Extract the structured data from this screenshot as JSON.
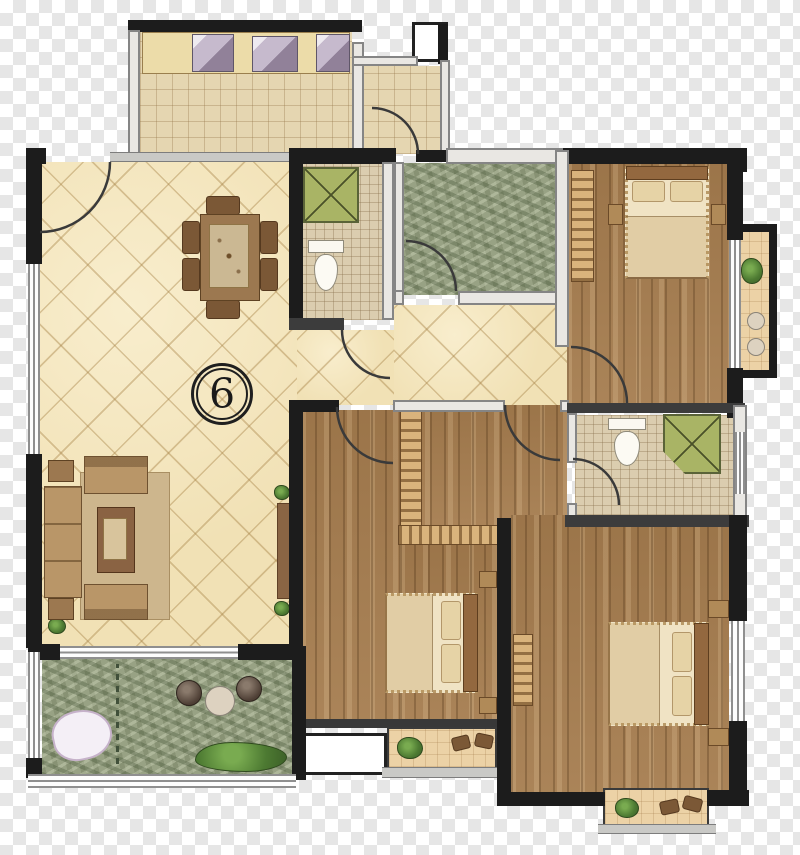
{
  "unit_label": "6",
  "plan": {
    "type": "apartment-floor-plan",
    "rooms": [
      {
        "name": "kitchen",
        "floor": "beige-grid-tile",
        "features": [
          "counter",
          "sink",
          "stove",
          "appliance"
        ]
      },
      {
        "name": "entry-porch",
        "floor": "beige-grid-tile",
        "features": [
          "duct-box",
          "door-swing"
        ]
      },
      {
        "name": "living-dining-room",
        "floor": "beige-diagonal-tile",
        "features": [
          "dining-table-with-six-chairs",
          "sofa-set",
          "coffee-table",
          "rug",
          "tv-cabinet",
          "unit-number-badge"
        ]
      },
      {
        "name": "shared-bathroom",
        "floor": "fine-mosaic-tile",
        "fixtures": [
          "shower",
          "toilet"
        ]
      },
      {
        "name": "multipurpose-room",
        "floor": "green-textured"
      },
      {
        "name": "bedroom-top-right",
        "floor": "wood-plank",
        "furniture": [
          "double-bed",
          "nightstand",
          "nightstand",
          "wardrobe"
        ]
      },
      {
        "name": "bedroom-middle",
        "floor": "wood-plank",
        "furniture": [
          "double-bed",
          "nightstand",
          "nightstand",
          "wardrobe"
        ]
      },
      {
        "name": "master-bedroom",
        "floor": "wood-plank",
        "furniture": [
          "double-bed",
          "nightstand",
          "nightstand",
          "wardrobe"
        ]
      },
      {
        "name": "ensuite-bathroom",
        "floor": "fine-mosaic-tile",
        "fixtures": [
          "shower",
          "toilet"
        ]
      },
      {
        "name": "dressing-corridor",
        "floor": "wood-plank",
        "furniture": [
          "wardrobe-l-shape"
        ]
      },
      {
        "name": "garden-balcony",
        "floor": "green-textured",
        "features": [
          "decorative-stone",
          "planter",
          "planter",
          "round-table",
          "shrub"
        ]
      },
      {
        "name": "side-balcony-right",
        "floor": "tan-tile",
        "features": [
          "plant",
          "stool",
          "stool"
        ]
      },
      {
        "name": "balcony-bottom-middle",
        "floor": "tan-tile",
        "features": [
          "plant",
          "chairs"
        ]
      },
      {
        "name": "master-balcony",
        "floor": "tan-tile",
        "features": [
          "plant",
          "chairs"
        ]
      }
    ],
    "door_swing_count": 8,
    "window_count": 6
  },
  "palette": {
    "tile_beige": "#f1e1b5",
    "tile_kitchen": "#e5d6b1",
    "tile_bath": "#dbcdaf",
    "wood": "#a57c4e",
    "green_texture": "#98a284",
    "wall_black": "#1c1c1c",
    "wall_gray": "#858585",
    "shower_green": "#a9b465",
    "balcony_tan": "#ecd2a6",
    "checker_gray": "#e6e6e6"
  }
}
